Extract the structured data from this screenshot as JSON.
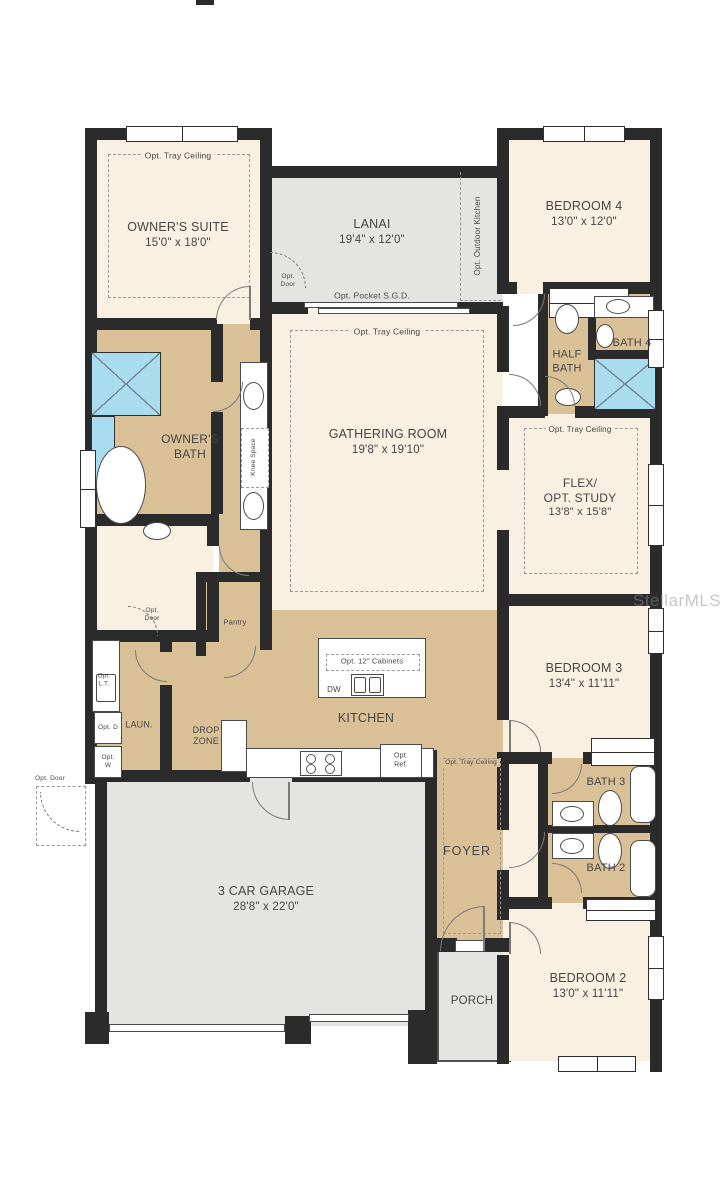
{
  "watermark": "StellarMLS",
  "colors": {
    "wall": "#2b2b2b",
    "room_cream": "#f8f1e2",
    "room_tan": "#d9c096",
    "room_gray": "#e4e4e2",
    "shower_blue": "#a9dcee",
    "text": "#454545"
  },
  "rooms": {
    "owners_suite": {
      "name": "OWNER'S SUITE",
      "dims": "15'0\" x 18'0\""
    },
    "lanai": {
      "name": "LANAI",
      "dims": "19'4\" x 12'0\""
    },
    "bedroom4": {
      "name": "BEDROOM 4",
      "dims": "13'0\" x 12'0\""
    },
    "gathering_room": {
      "name": "GATHERING ROOM",
      "dims": "19'8\" x 19'10\""
    },
    "flex": {
      "name1": "FLEX/",
      "name2": "OPT. STUDY",
      "dims": "13'8\" x 15'8\""
    },
    "owners_bath": {
      "name": "OWNER'S BATH"
    },
    "half_bath": {
      "name": "HALF BATH"
    },
    "bath4": {
      "name": "BATH 4"
    },
    "bedroom3": {
      "name": "BEDROOM 3",
      "dims": "13'4\" x 11'11\""
    },
    "bath3": {
      "name": "BATH 3"
    },
    "bath2": {
      "name": "BATH 2"
    },
    "bedroom2": {
      "name": "BEDROOM 2",
      "dims": "13'0\" x 11'11\""
    },
    "kitchen": {
      "name": "KITCHEN"
    },
    "laundry": {
      "name": "LAUN."
    },
    "drop_zone": {
      "name": "DROP ZONE"
    },
    "pantry": {
      "name": "Pantry"
    },
    "foyer": {
      "name": "FOYER"
    },
    "garage": {
      "name": "3 CAR GARAGE",
      "dims": "28'8\" x 22'0\""
    },
    "porch": {
      "name": "PORCH"
    }
  },
  "annotations": {
    "opt_tray": "Opt. Tray Ceiling",
    "opt_pocket_sgd": "Opt. Pocket S.G.D.",
    "opt_outdoor_kitchen": "Opt. Outdoor Kitchen",
    "opt_door": "Opt. Door",
    "knee_space": "Knee Space",
    "opt_12_cabinets": "Opt. 12\" Cabinets",
    "dw": "DW",
    "opt_ref": "Opt. Ref.",
    "opt_lt": "Opt. L.T.",
    "opt_d": "Opt. D",
    "opt_w": "Opt. W"
  }
}
